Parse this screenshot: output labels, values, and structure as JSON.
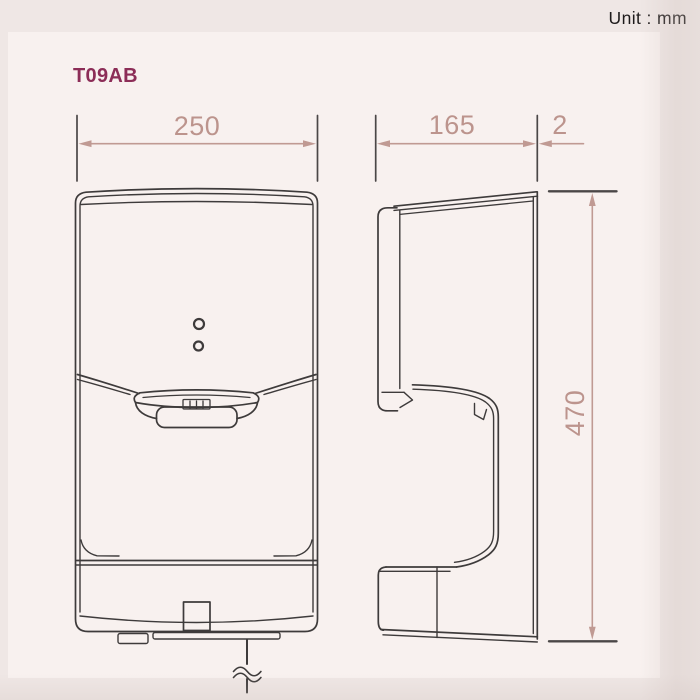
{
  "header": {
    "unit_label": "Unit : mm",
    "model_code": "T09AB"
  },
  "drawing": {
    "views": [
      {
        "id": "front-view",
        "description": "front elevation of hand dryer"
      },
      {
        "id": "side-view",
        "description": "side elevation of hand dryer"
      }
    ],
    "dimensions": {
      "width": "250",
      "depth": "165",
      "front_panel_thickness": "2",
      "height": "470"
    }
  },
  "colors": {
    "background": "#efe7e5",
    "panel": "#f8f1ef",
    "line": "#3e3b3b",
    "extension_line": "#4b4747",
    "dimension_accent": "#bc948d",
    "title_text": "#8c2d57",
    "unit_text": "#1e1b1b"
  }
}
